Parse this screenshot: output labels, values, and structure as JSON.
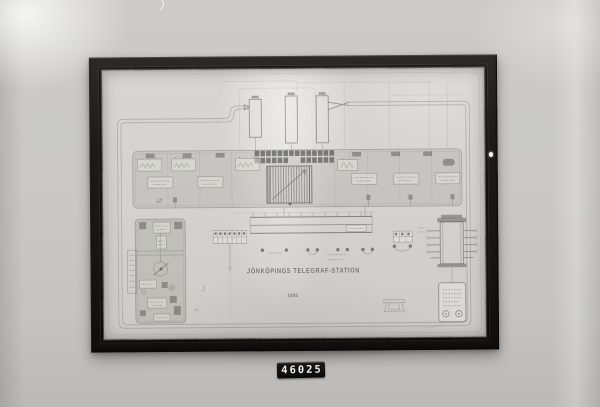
{
  "photo": {
    "object_label": "46025",
    "colors": {
      "wall": "#c8c7c5",
      "frame": "#211f1d",
      "paper": "#d3d2ce",
      "ink": "#55554f",
      "label_plate": "#0d0d0d",
      "label_text": "#f0efed"
    }
  },
  "drawing": {
    "title": "JÖNKÖPINGS TELEGRAF-STATION",
    "year": "1891"
  }
}
